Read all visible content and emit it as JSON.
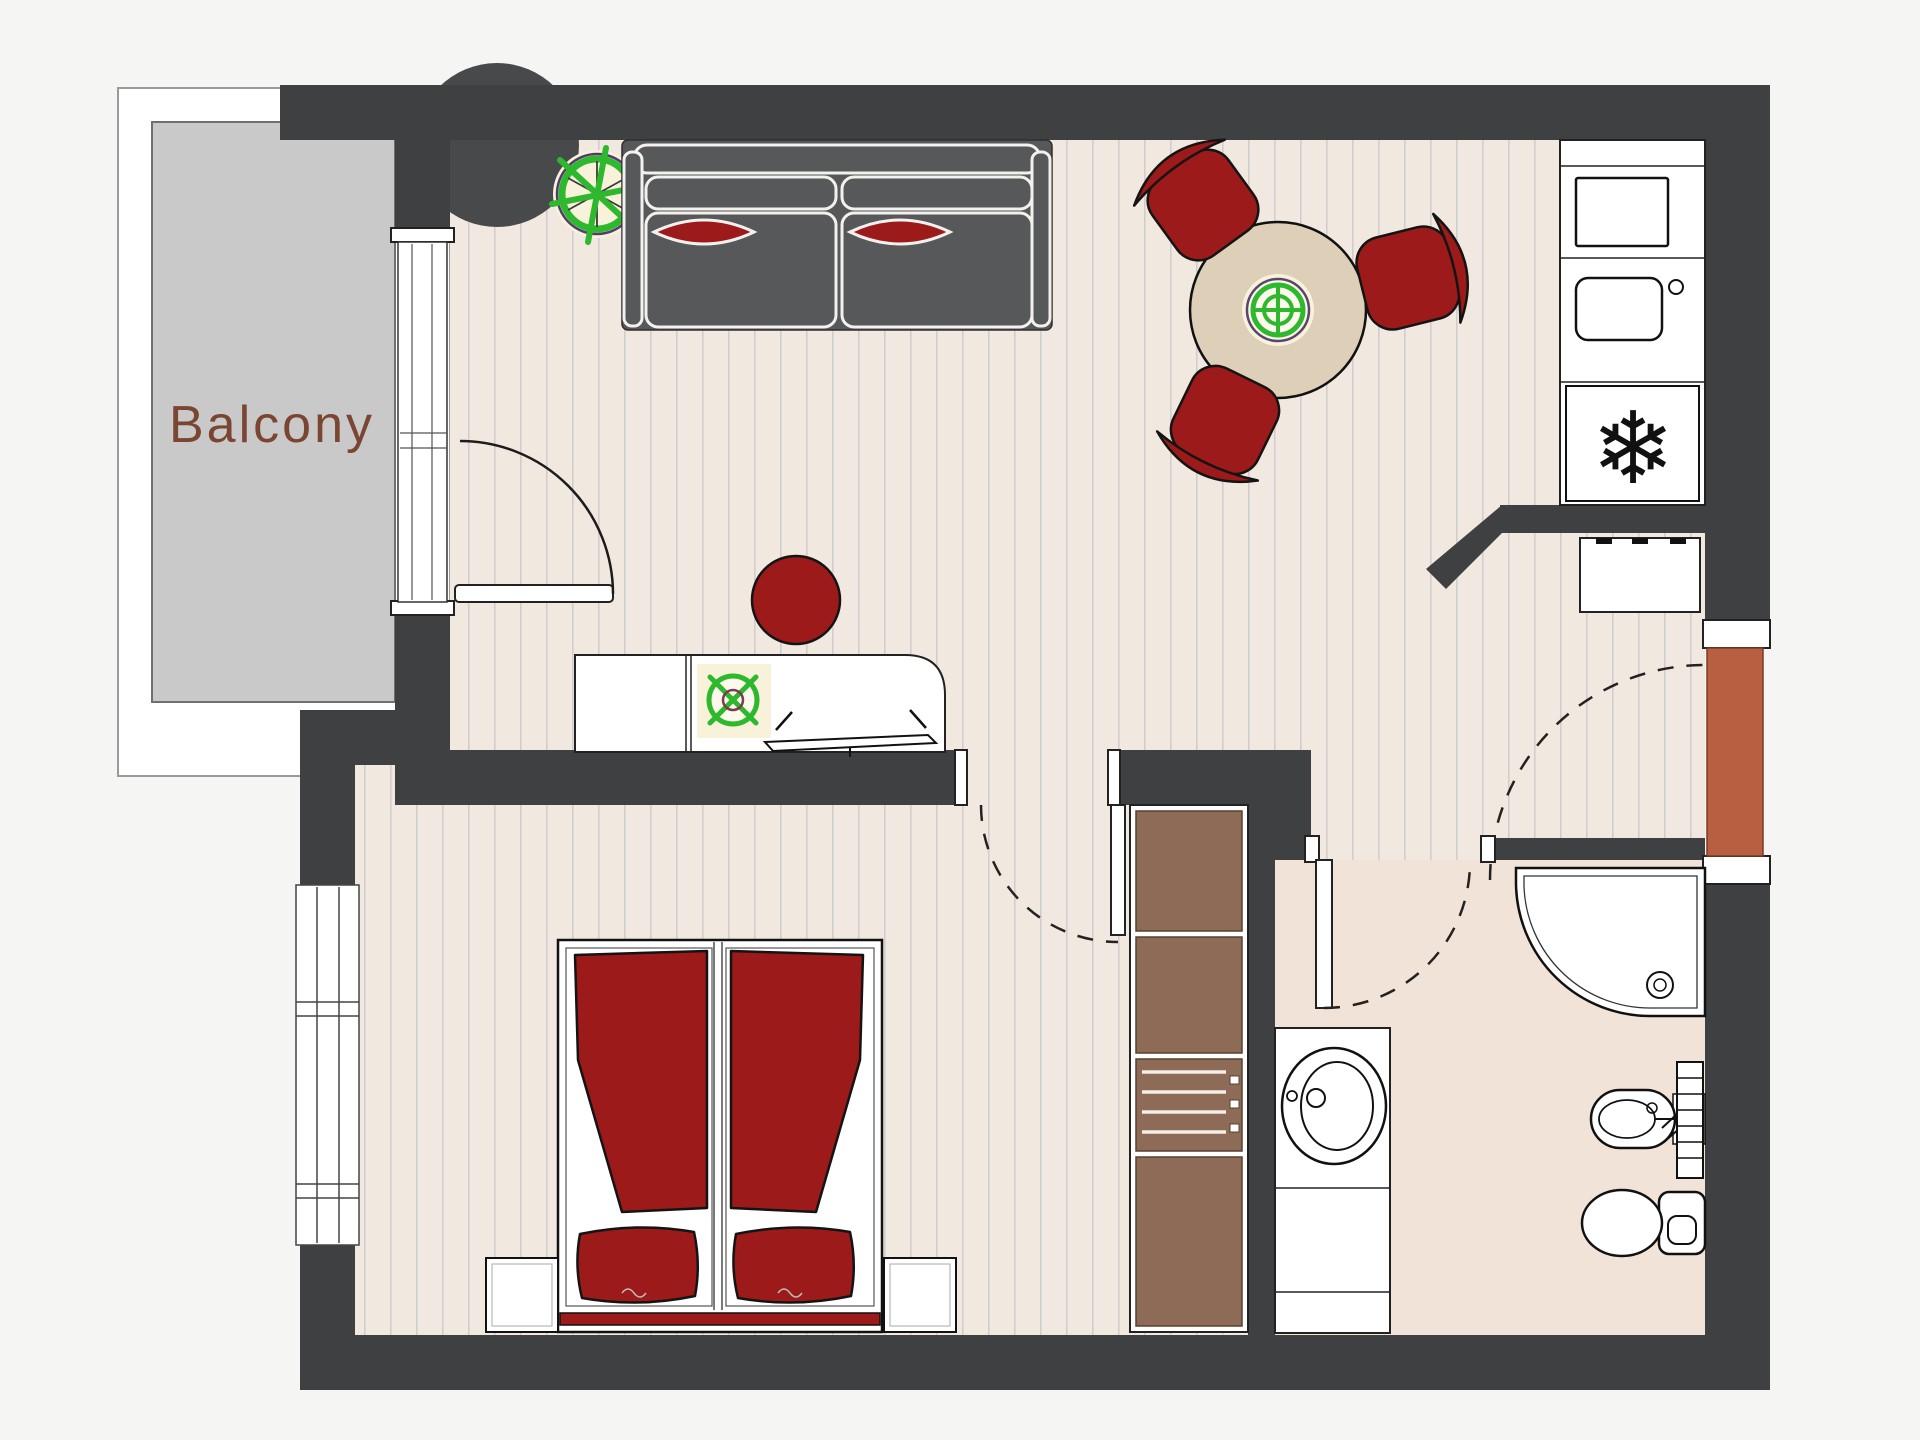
{
  "plan": {
    "balcony_label": "Balcony"
  },
  "icons": {
    "freezer_snowflake": "❄"
  },
  "colors": {
    "bg": "#f5f5f3",
    "wall": "#3e4042",
    "wall_bump": "#48494b",
    "floor": "#f1e9e0",
    "plank": "#d3cccf",
    "bath_floor": "#f2e3d8",
    "deck": "#c9c9c9",
    "sofa": "#56585a",
    "red": "#9c1a19",
    "wood": "#8e6b57",
    "table": "#ddcfb8",
    "green": "#2eb82e",
    "terracotta": "#b85f41",
    "label": "#7a4531"
  }
}
